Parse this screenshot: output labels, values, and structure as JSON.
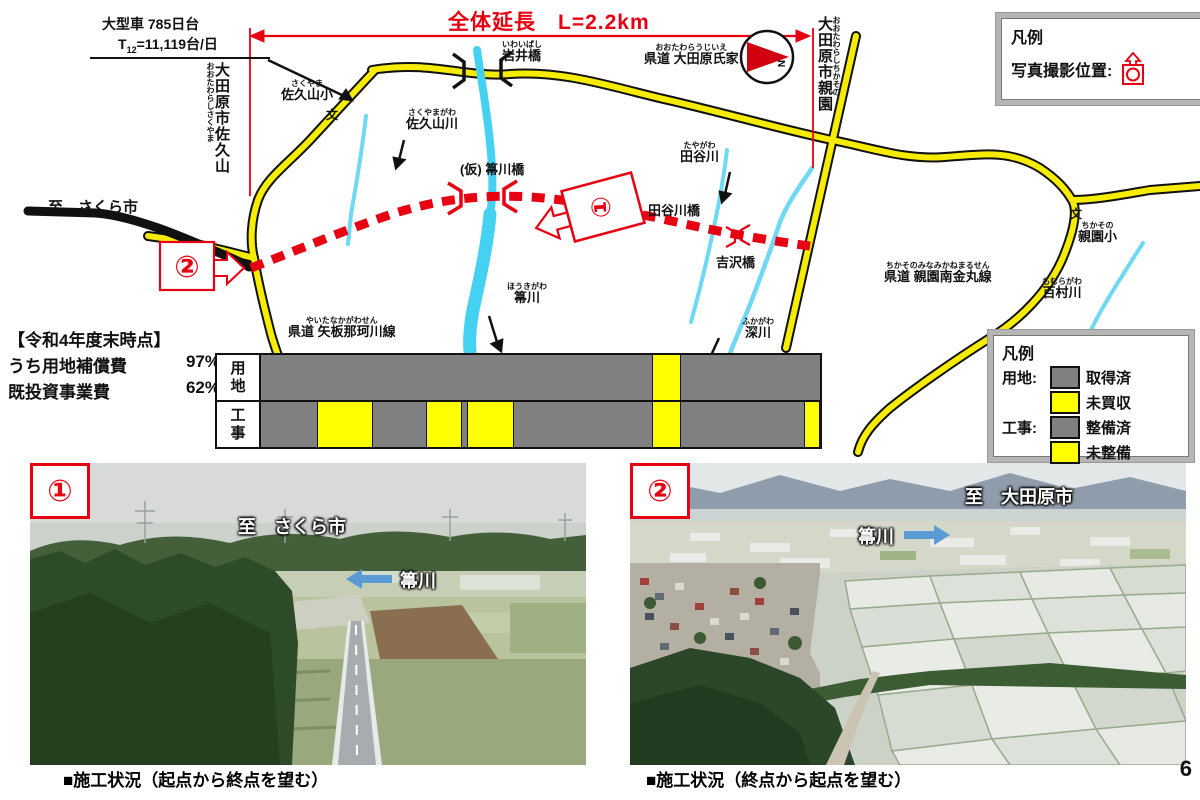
{
  "page": {
    "number": "6"
  },
  "map": {
    "title": "全体延長　L=2.2km",
    "traffic_note": {
      "line1": "大型車 785日台",
      "t": "T",
      "t_sub": "12",
      "t_rest": "=11,119台/日"
    },
    "compass_n": "N",
    "markers": {
      "m1": "①",
      "m2": "②"
    },
    "legend_photo": {
      "title": "凡例",
      "label": "写真撮影位置:",
      "icon": "camera-position-icon"
    },
    "labels": {
      "sakuyama_school": {
        "furigana": "さくやま",
        "text": "佐久山小"
      },
      "school_symbol_1": {
        "text": "文"
      },
      "sakuyama_river": {
        "furigana": "さくやまがわ",
        "text": "佐久山川"
      },
      "iwai_bridge": {
        "furigana": "いわいばし",
        "text": "岩井橋"
      },
      "houki_bridge_planned": {
        "text": "(仮) 箒川橋"
      },
      "houki_river": {
        "furigana": "ほうきがわ",
        "text": "箒川"
      },
      "route_yaita": {
        "furigana": "やいたなかがわせん",
        "text": "県道 矢板那珂川線"
      },
      "to_sakura": {
        "text": "至　さくら市"
      },
      "taya_river": {
        "furigana": "たやがわ",
        "text": "田谷川"
      },
      "taya_bridge": {
        "text": "田谷川橋"
      },
      "yoshizawa_bridge": {
        "text": "吉沢橋"
      },
      "fuka_river": {
        "furigana": "ふかがわ",
        "text": "深川"
      },
      "route_ujiie": {
        "furigana": "おおたわらうじいえ",
        "text": "県道 大田原氏家"
      },
      "route_chikasono": {
        "furigana": "ちかそのみなみかねまるせん",
        "text": "県道 親園南金丸線"
      },
      "chikasono_school": {
        "furigana": "ちかその",
        "text": "親園小"
      },
      "school_symbol_2": {
        "text": "文"
      },
      "momura_river": {
        "furigana": "もむらがわ",
        "text": "百村川"
      },
      "city_sakuyama": {
        "furigana": "おおたわらしさくやま",
        "text": "大田原市佐久山"
      },
      "city_chikasono": {
        "furigana": "おおたわらしちかその",
        "text": "大田原市親園"
      }
    },
    "colors": {
      "accent_red": "#e60012",
      "road_yellow": "#f5ec00",
      "river_cyan": "#45d2f2"
    }
  },
  "status": {
    "heading": "【令和4年度末時点】",
    "rows": [
      {
        "label": "うち用地補償費",
        "value": "97%"
      },
      {
        "label": "既投資事業費",
        "value": "62%"
      }
    ]
  },
  "chart_data": {
    "type": "bar",
    "orientation": "horizontal",
    "rows": [
      {
        "label": "用\n地",
        "yellow_segments": [
          [
            0.7,
            0.752
          ]
        ]
      },
      {
        "label": "工\n事",
        "yellow_segments": [
          [
            0.1,
            0.2
          ],
          [
            0.296,
            0.36
          ],
          [
            0.368,
            0.452
          ],
          [
            0.7,
            0.752
          ],
          [
            0.972,
            1.0
          ]
        ]
      }
    ],
    "colors": {
      "done": "#808080",
      "pending": "#ffff00"
    }
  },
  "legend_status": {
    "title": "凡例",
    "items": [
      {
        "group": "用地:",
        "swatch": "#808080",
        "label": "取得済"
      },
      {
        "group": "",
        "swatch": "#ffff00",
        "label": "未買収"
      },
      {
        "group": "工事:",
        "swatch": "#808080",
        "label": "整備済"
      },
      {
        "group": "",
        "swatch": "#ffff00",
        "label": "未整備"
      }
    ]
  },
  "photos": [
    {
      "marker": "①",
      "label_dest": "至　さくら市",
      "label_river": "箒川",
      "arrow": "left",
      "caption": "■施工状況（起点から終点を望む）"
    },
    {
      "marker": "②",
      "label_dest": "至　大田原市",
      "label_river": "箒川",
      "arrow": "right",
      "caption": "■施工状況（終点から起点を望む）"
    }
  ]
}
